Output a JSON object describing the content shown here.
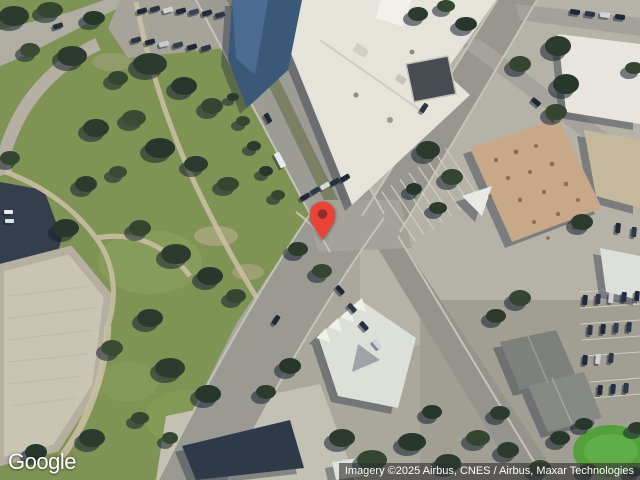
{
  "map": {
    "view_type": "satellite",
    "watermark": "Google",
    "attribution": "Imagery ©2025 Airbus, CNES / Airbus, Maxar Technologies",
    "marker": {
      "fill": "#EA4335",
      "dot": "#8C2F28"
    }
  }
}
